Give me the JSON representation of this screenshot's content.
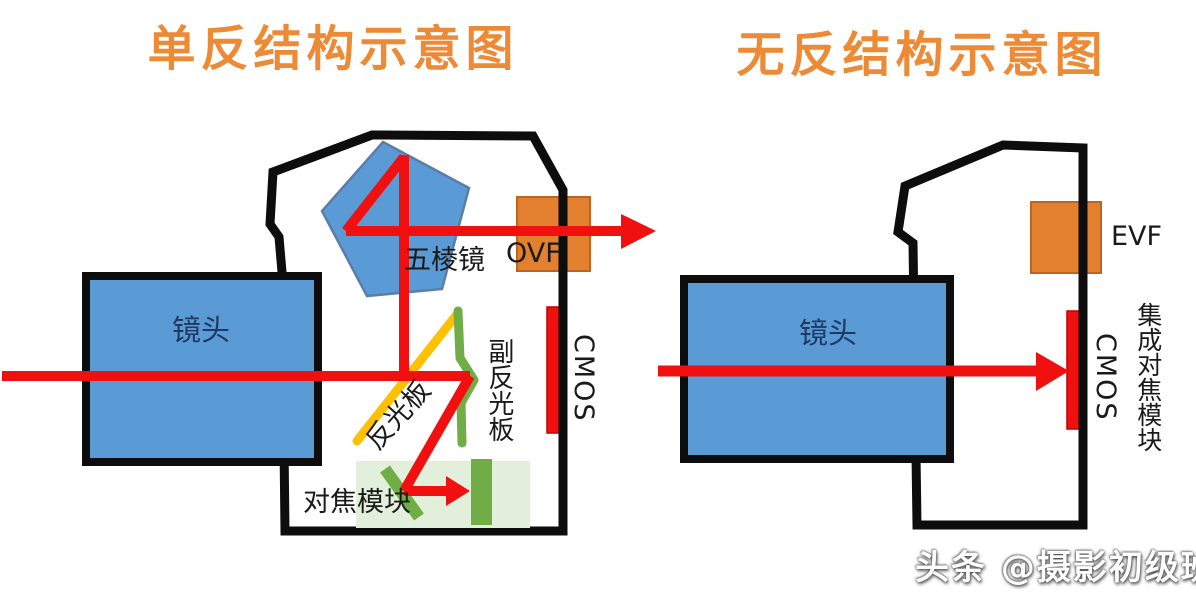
{
  "colors": {
    "title-orange": "#EC8A35",
    "shape-blue": "#5B9BD5",
    "shape-blue-border": "#5a7da9",
    "box-orange": "#E2802F",
    "box-orange-border": "#BF6320",
    "mirror-yellow": "#FFC000",
    "green": "#70AD47",
    "light-green": "#E2EFDA",
    "red": "#F01010",
    "red-dark": "#C00000",
    "outline-black": "#0D0D0D",
    "label-black": "#1A1A1A",
    "lens-navy": "#1F3864",
    "watermark-white": "#FFFFFF"
  },
  "left_diagram": {
    "title": "单反结构示意图",
    "lens_label": "镜头",
    "pentaprism_label": "五棱镜",
    "ovf_label": "OVF",
    "cmos_label": "CMOS",
    "main_mirror_label": "反光板",
    "secondary_mirror_label": "副反光板",
    "af_module_label": "对焦模块"
  },
  "right_diagram": {
    "title": "无反结构示意图",
    "lens_label": "镜头",
    "evf_label": "EVF",
    "cmos_label": "CMOS",
    "integrated_af_label": "集成对焦模块"
  },
  "watermark": "头条 @摄影初级班"
}
